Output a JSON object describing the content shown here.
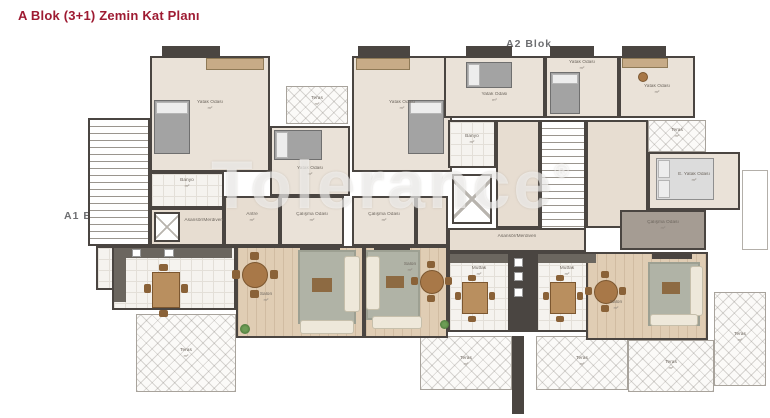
{
  "title": {
    "text": "A Blok (3+1) Zemin Kat Planı"
  },
  "block_labels": {
    "a1": "A1 Blok",
    "a2": "A2 Blok"
  },
  "watermark": {
    "text": "Tolerance",
    "reg": "®"
  },
  "colors": {
    "title": "#9E1B32",
    "block_label": "#6D6E71",
    "wall": "#4A4541",
    "room_fill": "#EAE2D8",
    "wood_floor": "#E0CDB4",
    "watermark": "#FFFFFF"
  },
  "rooms": {
    "bedroom1": {
      "label": "Yatak Odası",
      "area": "m²"
    },
    "bedroom2": {
      "label": "Yatak Odası",
      "area": "m²"
    },
    "bedroom3": {
      "label": "Yatak Odası",
      "area": "m²"
    },
    "bedroom4": {
      "label": "Yatak Odası",
      "area": "m²"
    },
    "bedroom5": {
      "label": "Yatak Odası",
      "area": "m²"
    },
    "bedroom6": {
      "label": "Yatak Odası",
      "area": "m²"
    },
    "master": {
      "label": "E. Yatak Odası",
      "area": "m²"
    },
    "banyo1": {
      "label": "Banyo",
      "area": "m²"
    },
    "banyo2": {
      "label": "Banyo",
      "area": "m²"
    },
    "antre1": {
      "label": "Antre",
      "area": "m²"
    },
    "calisma1": {
      "label": "Çalışma Odası",
      "area": "m²"
    },
    "calisma2": {
      "label": "Çalışma Odası",
      "area": "m²"
    },
    "calisma3": {
      "label": "Çalışma Odası",
      "area": "m²"
    },
    "salon1": {
      "label": "Salon",
      "area": "m²"
    },
    "salon2": {
      "label": "Salon",
      "area": "m²"
    },
    "salon3": {
      "label": "Salon",
      "area": "m²"
    },
    "mutfak2": {
      "label": "Mutfak",
      "area": "m²"
    },
    "mutfak3": {
      "label": "Mutfak",
      "area": "m²"
    },
    "hall1": {
      "label": "Asansör/Merdiven"
    },
    "hall2": {
      "label": "Asansör/Merdiven"
    },
    "teras_top1": {
      "label": "Teras",
      "area": "m²"
    },
    "teras_top2": {
      "label": "Teras",
      "area": "m²"
    },
    "teras_bl": {
      "label": "Teras",
      "area": "m²"
    },
    "teras_bc1": {
      "label": "Teras",
      "area": "m²"
    },
    "teras_bc2": {
      "label": "Teras",
      "area": "m²"
    },
    "teras_br": {
      "label": "Teras",
      "area": "m²"
    },
    "teras_fr": {
      "label": "Teras",
      "area": "m²"
    }
  }
}
